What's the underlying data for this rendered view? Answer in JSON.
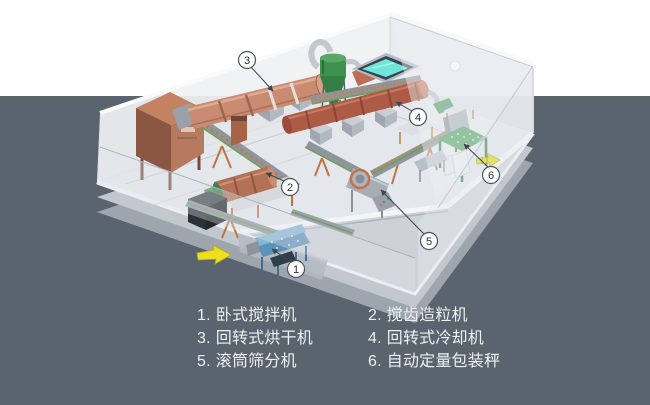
{
  "scene": {
    "description": "Isometric factory layout of an organic fertilizer production line inside a transparent-walled building",
    "background_top_color": "#ffffff",
    "background_bottom_color": "#5a646e",
    "callouts": [
      {
        "num": "1"
      },
      {
        "num": "2"
      },
      {
        "num": "3"
      },
      {
        "num": "4"
      },
      {
        "num": "5"
      },
      {
        "num": "6"
      }
    ]
  },
  "legend": {
    "items": [
      {
        "num": "1.",
        "label": "卧式搅拌机"
      },
      {
        "num": "2.",
        "label": "搅齿造粒机"
      },
      {
        "num": "3.",
        "label": "回转式烘干机"
      },
      {
        "num": "4.",
        "label": "回转式冷却机"
      },
      {
        "num": "5.",
        "label": "滚筒筛分机"
      },
      {
        "num": "6.",
        "label": "自动定量包装秤"
      }
    ]
  },
  "colors": {
    "dryer_drum": "#c98b71",
    "cooler_drum": "#ae5b45",
    "granulator_drum": "#b37156",
    "mixer_body": "#5d92b8",
    "packer_table": "#4f9d5e",
    "cyclone": "#3f9150",
    "furnace": "#b57a5f",
    "pool_water": "#6fe6dc",
    "flow_arrow": "#ecdf1e",
    "floor": "#e4e7eb",
    "slab_side": "#c3c8cf",
    "legend_text": "#eef0f3",
    "callout_border": "#4d535a"
  }
}
